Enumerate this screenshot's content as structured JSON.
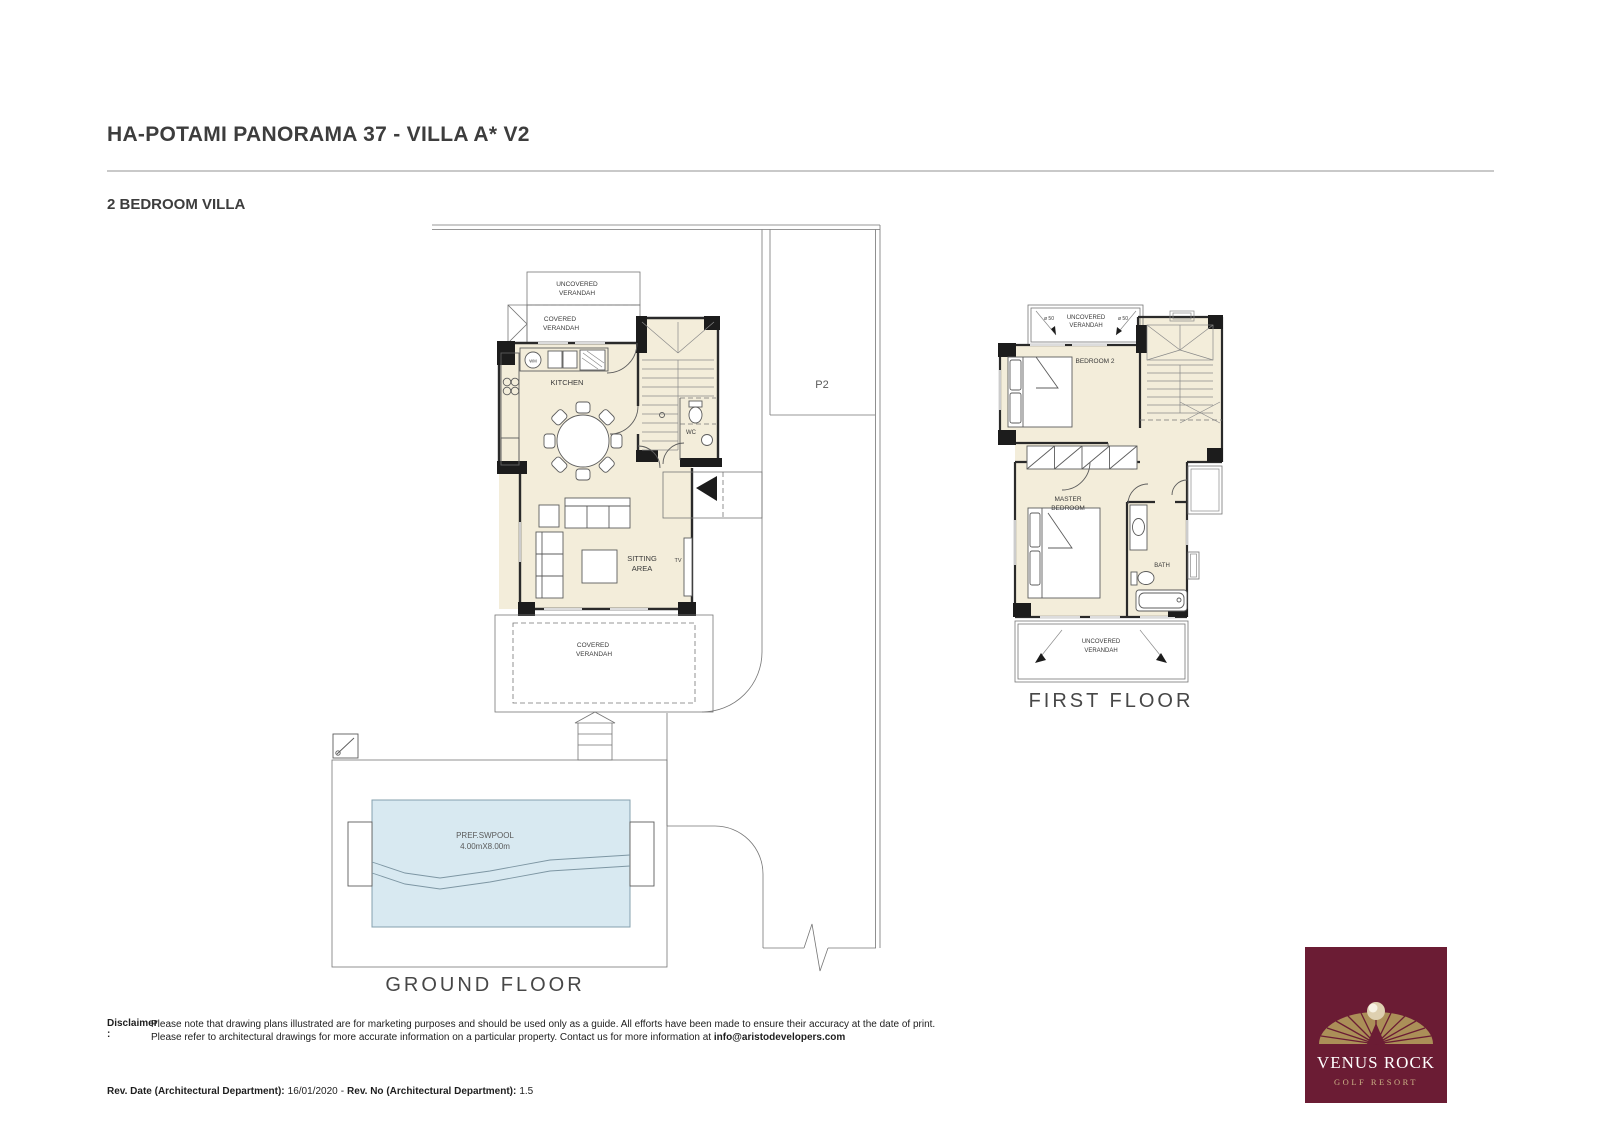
{
  "header": {
    "title": "HA-POTAMI PANORAMA 37 - VILLA A*  V2",
    "subtitle": "2 BEDROOM VILLA"
  },
  "ground_floor": {
    "caption": "GROUND FLOOR",
    "labels": {
      "uncovered": "UNCOVERED",
      "covered": "COVERED",
      "verandah": "VERANDAH",
      "kitchen": "KITCHEN",
      "wm": "WM",
      "wc": "WC",
      "sitting_1": "SITTING",
      "sitting_2": "AREA",
      "tv": "TV",
      "pool_1": "PREF.SWPOOL",
      "pool_2": "4.00mX8.00m",
      "parking": "P2"
    }
  },
  "first_floor": {
    "caption": "FIRST FLOOR",
    "labels": {
      "uncovered": "UNCOVERED",
      "verandah": "VERANDAH",
      "bedroom2": "BEDROOM 2",
      "master_1": "MASTER",
      "master_2": "BEDROOM",
      "bath": "BATH",
      "dia_left": "ø 50",
      "dia_right": "ø 50"
    }
  },
  "footer": {
    "disclaimer_label": "Disclaimer :",
    "disclaimer_line1": "Please note that drawing plans illustrated are for marketing purposes and should be used only as a guide. All efforts have been made to ensure their accuracy at the date of print.",
    "disclaimer_line2": "Please refer to architectural drawings for more accurate information on a particular property. Contact us for more information at ",
    "disclaimer_email": "info@aristodevelopers.com",
    "rev_date_label": "Rev. Date (Architectural Department):",
    "rev_date_value": "16/01/2020",
    "rev_separator": "-",
    "rev_no_label": "Rev. No (Architectural Department):",
    "rev_no_value": "1.5"
  },
  "logo": {
    "line1": "VENUS ROCK",
    "line2": "GOLF RESORT",
    "colors": {
      "background": "#6b1c34",
      "gold": "#ab8f58",
      "text": "#ffffff"
    }
  },
  "colors": {
    "floor_fill": "#f3edda",
    "pool_fill": "#d8e9f1",
    "wall": "#2a2a2a",
    "thin_line": "#767676",
    "divider": "#c9c9c9",
    "heading_text": "#3d3d3d"
  }
}
